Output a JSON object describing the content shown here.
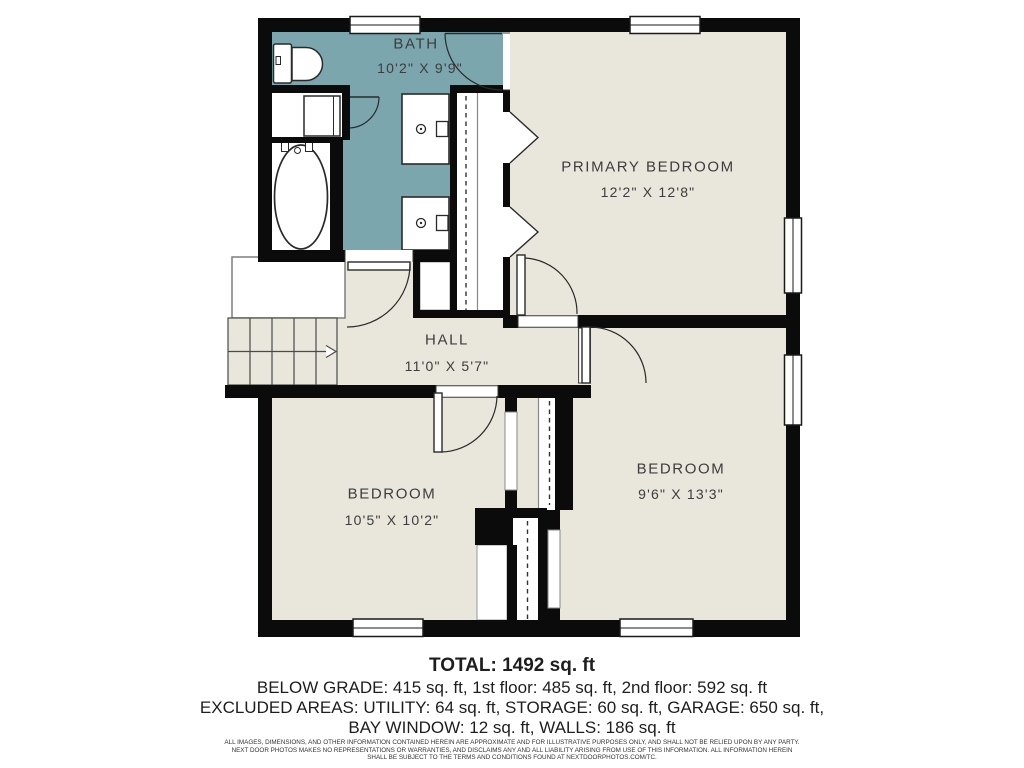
{
  "plan": {
    "rooms": [
      {
        "id": "bath",
        "name": "BATH",
        "dims": "10'2\" X 9'9\""
      },
      {
        "id": "primary_bedroom",
        "name": "PRIMARY BEDROOM",
        "dims": "12'2\" X 12'8\""
      },
      {
        "id": "hall",
        "name": "HALL",
        "dims": "11'0\" X 5'7\""
      },
      {
        "id": "bedroom_left",
        "name": "BEDROOM",
        "dims": "10'5\" X 10'2\""
      },
      {
        "id": "bedroom_right",
        "name": "BEDROOM",
        "dims": "9'6\" X 13'3\""
      }
    ]
  },
  "summary": {
    "total": "TOTAL: 1492 sq. ft",
    "line1": "BELOW GRADE: 415 sq. ft, 1st floor: 485 sq. ft, 2nd floor: 592 sq. ft",
    "line2": "EXCLUDED AREAS: UTILITY: 64 sq. ft, STORAGE: 60 sq. ft, GARAGE: 650 sq. ft,",
    "line3": "BAY WINDOW: 12 sq. ft, WALLS: 186 sq. ft"
  },
  "disclaimer": {
    "line1": "ALL IMAGES, DIMENSIONS, AND OTHER INFORMATION CONTAINED HEREIN ARE APPROXIMATE AND FOR ILLUSTRATIVE PURPOSES ONLY, AND SHALL NOT BE RELIED UPON BY ANY PARTY.",
    "line2": "NEXT DOOR PHOTOS MAKES NO REPRESENTATIONS OR WARRANTIES, AND DISCLAIMS ANY AND ALL LIABILITY ARISING FROM USE OF THIS INFORMATION. ALL INFORMATION HEREIN",
    "line3": "SHALL BE SUBJECT TO THE TERMS AND CONDITIONS FOUND AT NEXTDOORPHOTOS.COM/TC."
  },
  "colors": {
    "bath": "#7BA6AE",
    "floor": "#E9E6DC",
    "wall": "#0B0B0B",
    "line": "#2B2B2B"
  }
}
